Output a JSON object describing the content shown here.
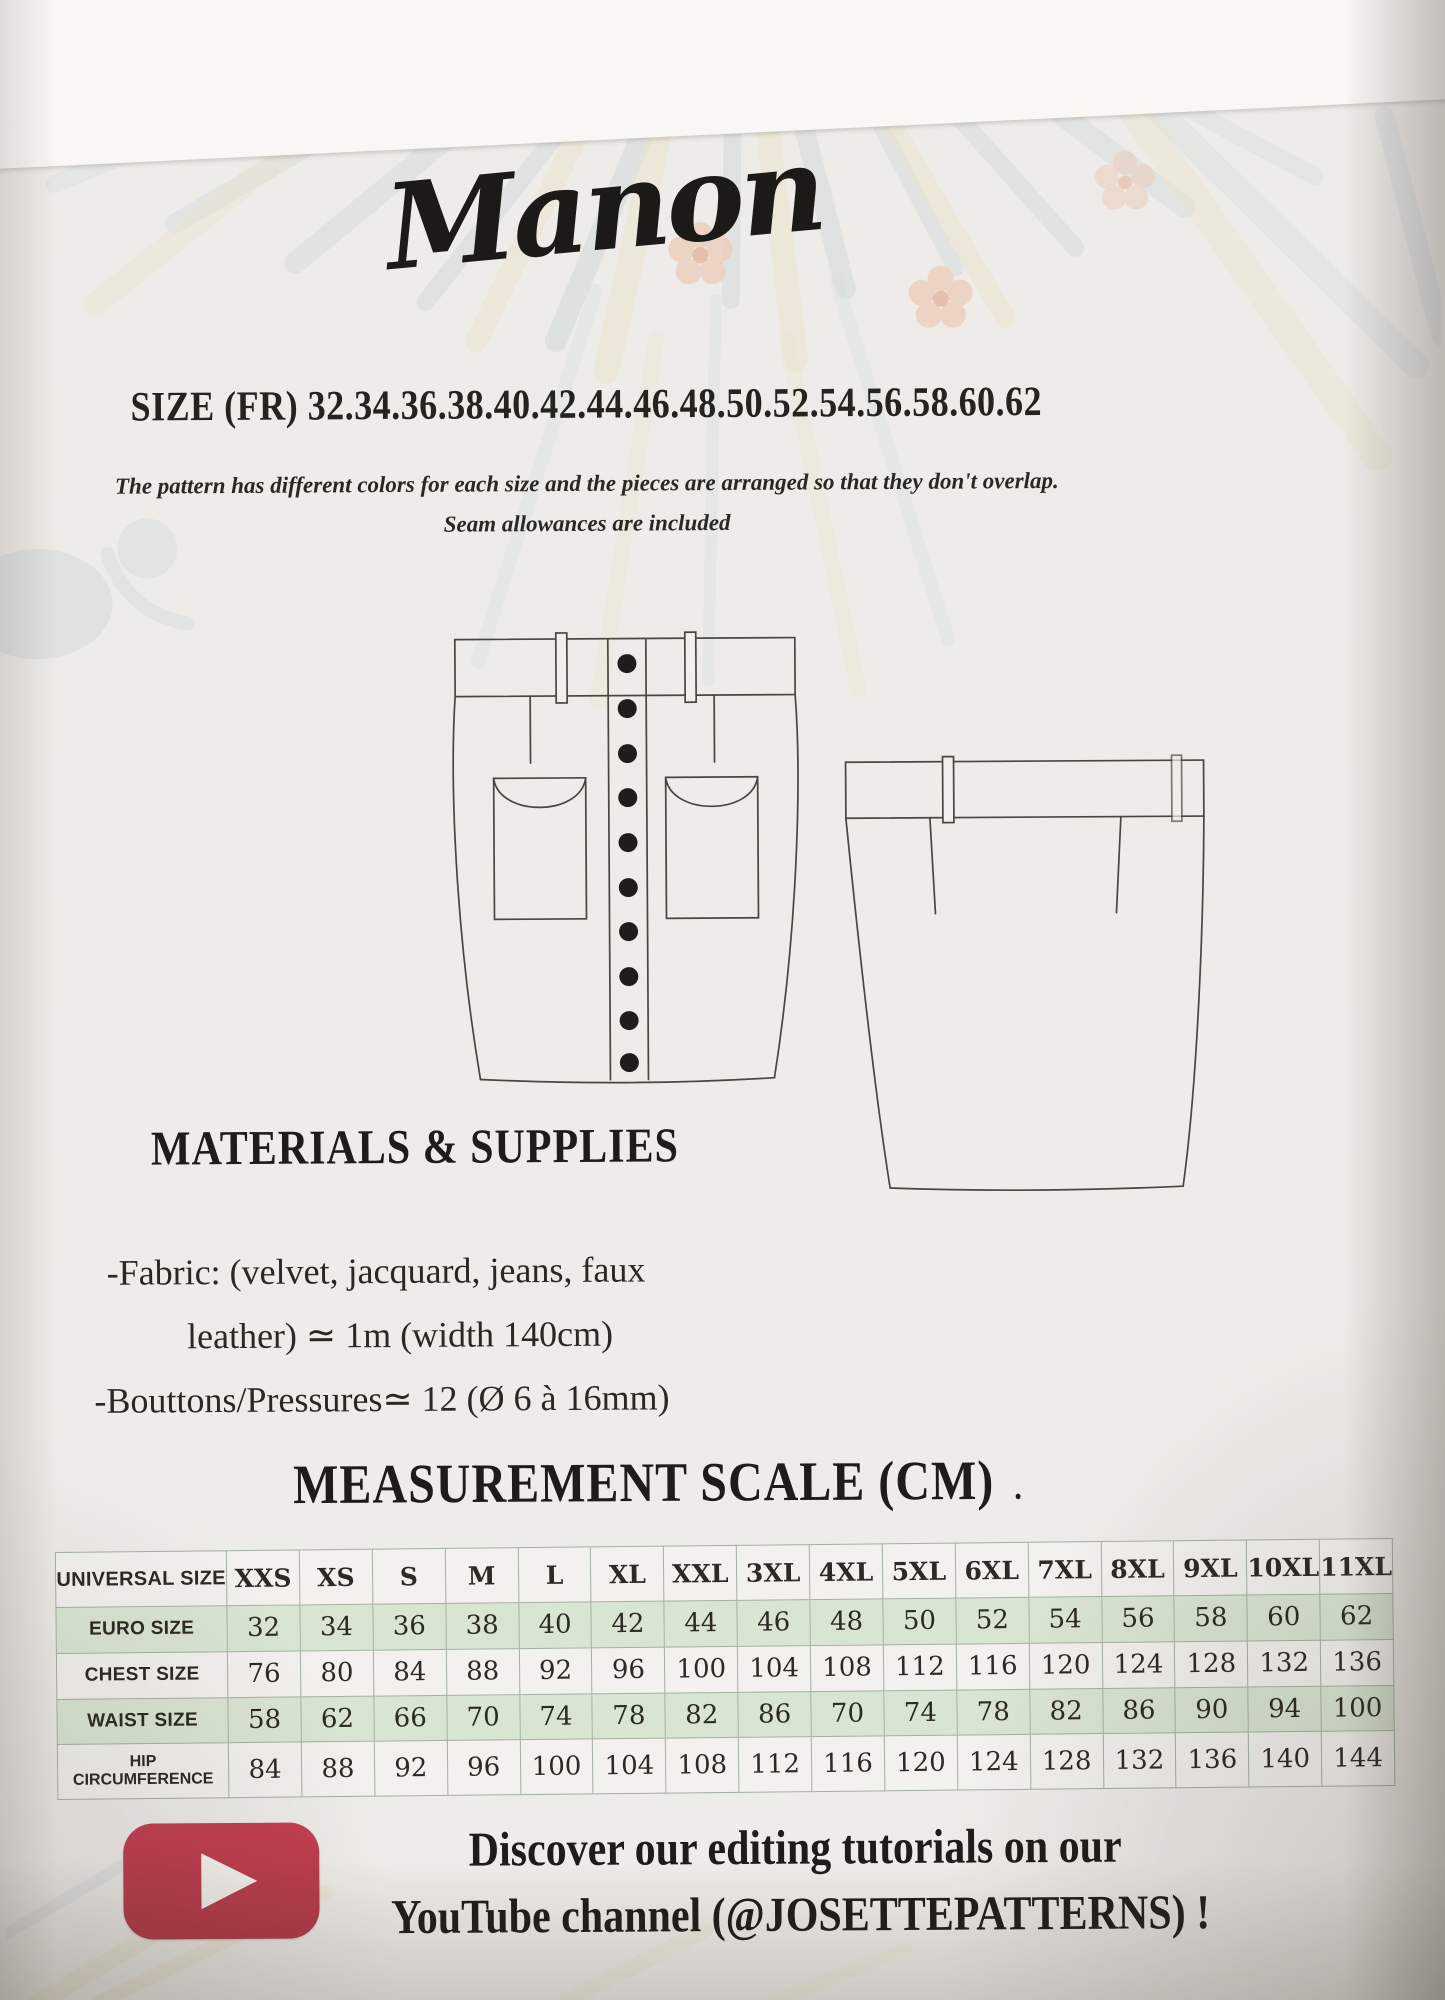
{
  "colors": {
    "paper": "#eeece8",
    "table_green": "#d9e5d3",
    "youtube_red": "#bc3a4d",
    "ink": "#25231e"
  },
  "header": {
    "title": "Manon",
    "size_line": "SIZE (FR) 32.34.36.38.40.42.44.46.48.50.52.54.56.58.60.62",
    "note_line1": "The pattern has different colors for each size and the pieces are arranged so that they don't overlap.",
    "note_line2": "Seam allowances are included"
  },
  "drawings": {
    "front": "skirt-front-technical-drawing",
    "back": "skirt-back-technical-drawing"
  },
  "materials": {
    "heading": "MATERIALS & SUPPLIES",
    "line1": "-Fabric: (velvet, jacquard, jeans, faux",
    "line2": "leather) ≃ 1m (width 140cm)",
    "line3": "-Bouttons/Pressures≃ 12 (Ø 6 à 16mm)"
  },
  "measurement": {
    "heading": "MEASUREMENT SCALE (CM)",
    "heading_dot": ".",
    "table": {
      "rows": [
        {
          "label": "UNIVERSAL SIZE",
          "values": [
            "XXS",
            "XS",
            "S",
            "M",
            "L",
            "XL",
            "XXL",
            "3XL",
            "4XL",
            "5XL",
            "6XL",
            "7XL",
            "8XL",
            "9XL",
            "10XL",
            "11XL"
          ]
        },
        {
          "label": "EURO SIZE",
          "values": [
            "32",
            "34",
            "36",
            "38",
            "40",
            "42",
            "44",
            "46",
            "48",
            "50",
            "52",
            "54",
            "56",
            "58",
            "60",
            "62"
          ]
        },
        {
          "label": "CHEST SIZE",
          "values": [
            "76",
            "80",
            "84",
            "88",
            "92",
            "96",
            "100",
            "104",
            "108",
            "112",
            "116",
            "120",
            "124",
            "128",
            "132",
            "136"
          ]
        },
        {
          "label": "WAIST SIZE",
          "values": [
            "58",
            "62",
            "66",
            "70",
            "74",
            "78",
            "82",
            "86",
            "70",
            "74",
            "78",
            "82",
            "86",
            "90",
            "94",
            "100"
          ]
        },
        {
          "label": "HIP CIRCUMFERENCE",
          "values": [
            "84",
            "88",
            "92",
            "96",
            "100",
            "104",
            "108",
            "112",
            "116",
            "120",
            "124",
            "128",
            "132",
            "136",
            "140",
            "144"
          ]
        }
      ]
    }
  },
  "footer": {
    "line1": "Discover our editing tutorials on our",
    "line2": "YouTube channel (@JOSETTEPATTERNS) !",
    "icon": "youtube-play-icon"
  }
}
